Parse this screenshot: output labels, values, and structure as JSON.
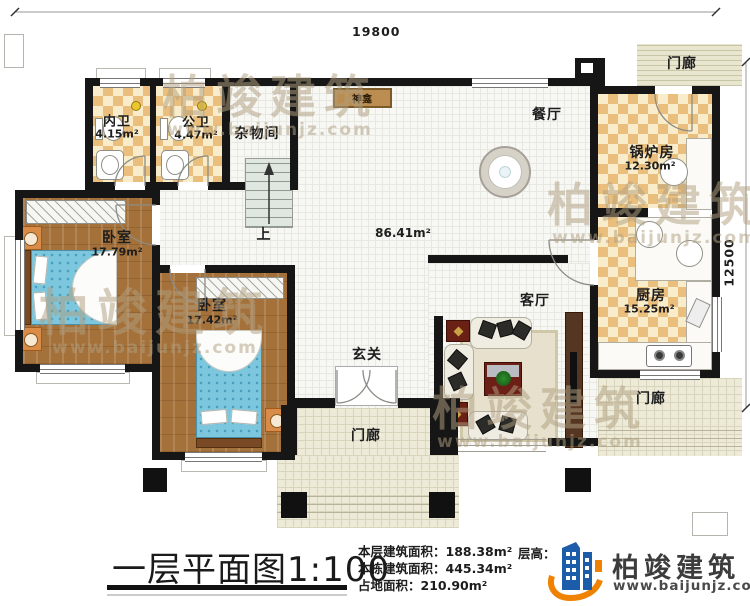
{
  "plan": {
    "dimensions": {
      "width_top": "19800",
      "height_right": "12500"
    },
    "rooms": {
      "neiwei": {
        "name": "内卫",
        "area": "4.15m²"
      },
      "gongwei": {
        "name": "公卫",
        "area": "4.47m²"
      },
      "zawujian": {
        "name": "杂物间"
      },
      "bedroom1": {
        "name": "卧室",
        "area": "17.79m²"
      },
      "bedroom2": {
        "name": "卧室",
        "area": "17.42m²"
      },
      "xuanguan": {
        "name": "玄关"
      },
      "keting": {
        "name": "客厅"
      },
      "canting": {
        "name": "餐厅"
      },
      "guolufang": {
        "name": "锅炉房",
        "area": "12.30m²"
      },
      "chufang": {
        "name": "厨房",
        "area": "15.25m²"
      },
      "menlang_top": {
        "name": "门廊"
      },
      "menlang_bottom": {
        "name": "门廊"
      },
      "menlang_right": {
        "name": "门廊"
      },
      "stairs": {
        "name": "上"
      },
      "shenkan": {
        "name": "神龛"
      },
      "open_area": {
        "area": "86.41m²"
      }
    }
  },
  "title_block": {
    "title": "一层平面图1:100",
    "stats": {
      "floor_area_label": "本层建筑面积：",
      "floor_area": "188.38m²",
      "building_area_label": "本栋建筑面积：",
      "building_area": "445.34m²",
      "footprint_label": "占地面积：",
      "footprint": "210.90m²",
      "floor_height_label": "层高："
    },
    "brand": {
      "name": "柏竣建筑",
      "site": "www.baijunjz.com"
    }
  },
  "watermark": {
    "text": "柏竣建筑",
    "site": "www.baijunjz.com"
  },
  "colors": {
    "accent_orange": "#ef8200",
    "accent_blue": "#1c5ca8",
    "wall": "#161616"
  }
}
